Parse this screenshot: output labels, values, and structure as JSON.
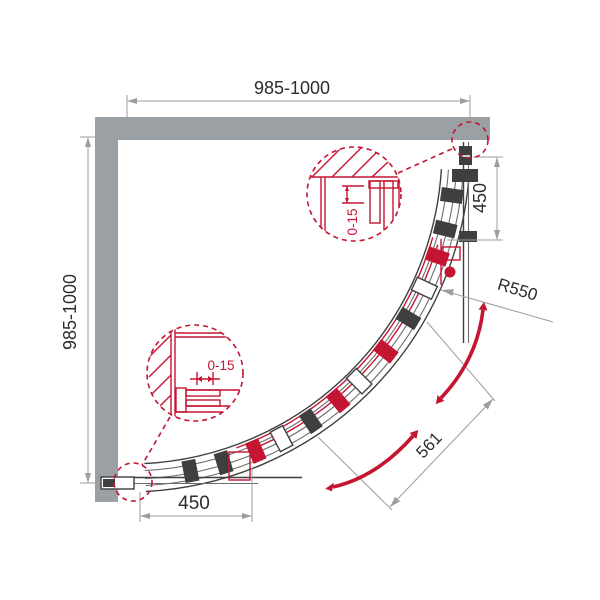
{
  "diagram": {
    "dimensions": {
      "top_width": "985-1000",
      "left_depth": "985-1000",
      "right_wall_segment": "450",
      "bottom_wall_segment": "450",
      "radius": "R550",
      "door_opening": "561"
    },
    "details": {
      "top_adjustment": "0-15",
      "bottom_adjustment": "0-15"
    },
    "colors": {
      "wall": "#9ba0a4",
      "outline": "#3f3f3f",
      "dimension_gray": "#9c9ea0",
      "text": "#2d2d2d",
      "accent_red": "#c41532"
    }
  }
}
